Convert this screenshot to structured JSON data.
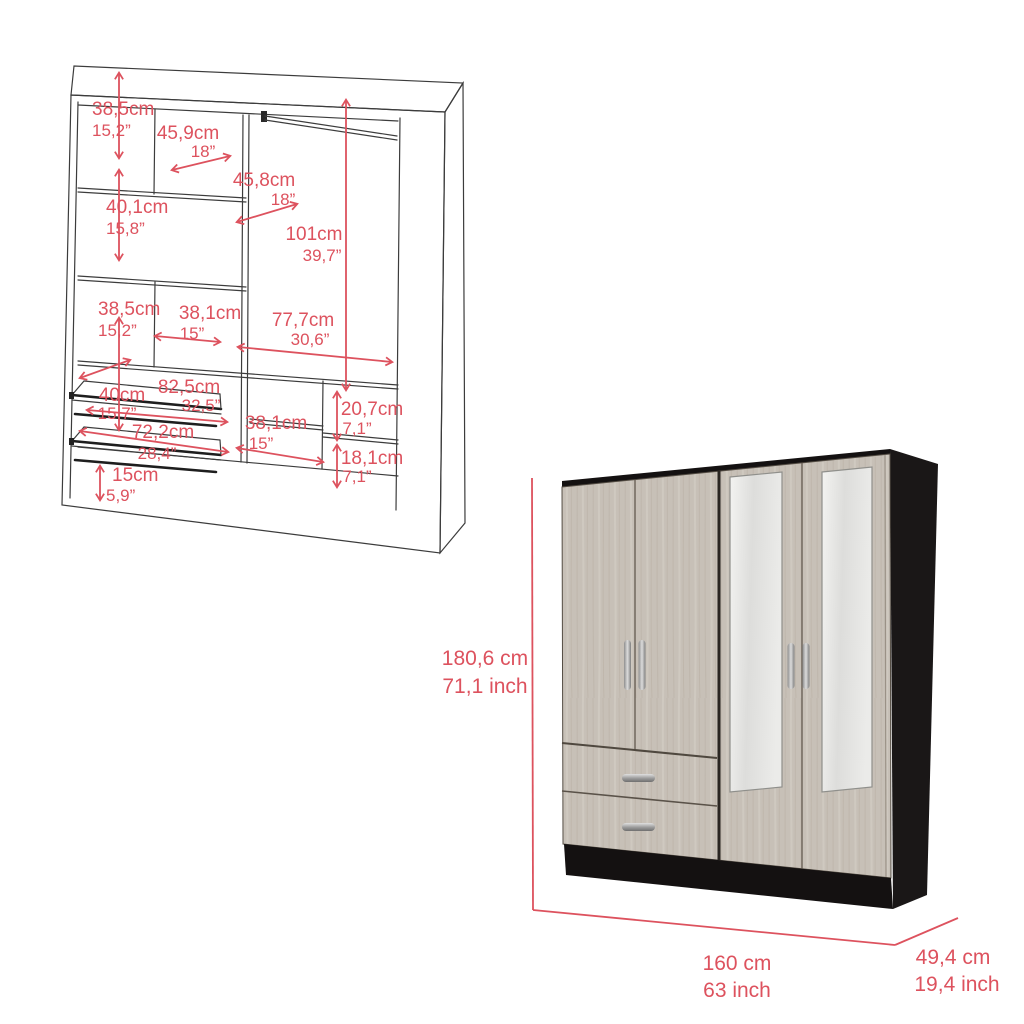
{
  "accent_color": "#dd525e",
  "wireframe": {
    "description": "interior dimension line drawing of wardrobe",
    "dims": [
      {
        "id": "top-left-compartment-height",
        "cm": "38,5cm",
        "in": "15,2”"
      },
      {
        "id": "top-shelf-width",
        "cm": "45,9cm",
        "in": "18”"
      },
      {
        "id": "middle-section-width",
        "cm": "45,8cm",
        "in": "18”"
      },
      {
        "id": "second-compartment-height",
        "cm": "40,1cm",
        "in": "15,8”"
      },
      {
        "id": "hanging-space-height",
        "cm": "101cm",
        "in": "39,7”"
      },
      {
        "id": "third-compartment-height",
        "cm": "38,5cm",
        "in": "15,2”"
      },
      {
        "id": "third-shelf-width",
        "cm": "38,1cm",
        "in": "15”"
      },
      {
        "id": "hanging-space-width",
        "cm": "77,7cm",
        "in": "30,6”"
      },
      {
        "id": "drawer-depth",
        "cm": "40cm",
        "in": "15,7”"
      },
      {
        "id": "drawer-outer-width",
        "cm": "82,5cm",
        "in": "32,5”"
      },
      {
        "id": "drawer-inner-width",
        "cm": "72,2cm",
        "in": "28,4”"
      },
      {
        "id": "lower-shelf-width",
        "cm": "38,1cm",
        "in": "15”"
      },
      {
        "id": "upper-cubby-height",
        "cm": "20,7cm",
        "in": "7,1”"
      },
      {
        "id": "lower-cubby-height",
        "cm": "18,1cm",
        "in": "7,1”"
      },
      {
        "id": "base-height",
        "cm": "15cm",
        "in": "5,9”"
      }
    ]
  },
  "product": {
    "description": "four door mirrored wardrobe render",
    "height": {
      "cm": "180,6 cm",
      "in": "71,1 inch"
    },
    "width": {
      "cm": "160 cm",
      "in": "63 inch"
    },
    "depth": {
      "cm": "49,4 cm",
      "in": "19,4 inch"
    },
    "colors": {
      "frame": "#1a1717",
      "wood": "#c7c0b7",
      "mirror": "#e6e6e4",
      "handle": "#b9b9b9"
    }
  }
}
